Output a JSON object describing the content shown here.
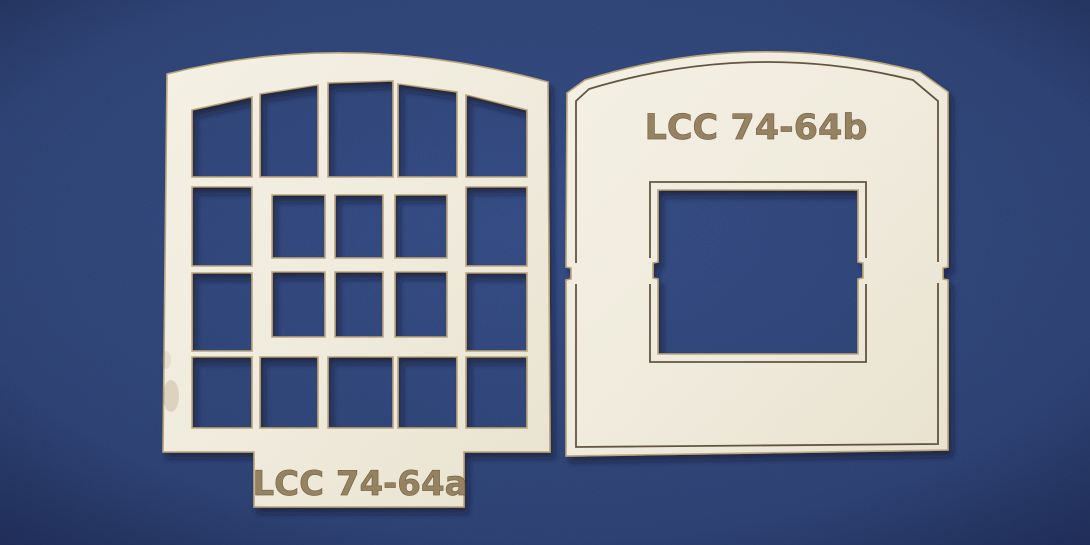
{
  "photo": {
    "description": "Two cream laser-cut chipboard model railway window parts lying on a dark blue card background"
  },
  "pieces": [
    {
      "label": "LCC 74-64a"
    },
    {
      "label": "LCC 74-64b"
    }
  ],
  "colors": {
    "background_center": "#33497e",
    "background_edge": "#273969",
    "board_face_light": "#f4f0e3",
    "board_face_dark": "#e8e1cc",
    "cut_edge": "#b9a275",
    "engraving": "#8c7857",
    "engraving_stroke": "#6e5a3c",
    "score_line": "#4a3b28",
    "shadow": "#0a1028"
  }
}
